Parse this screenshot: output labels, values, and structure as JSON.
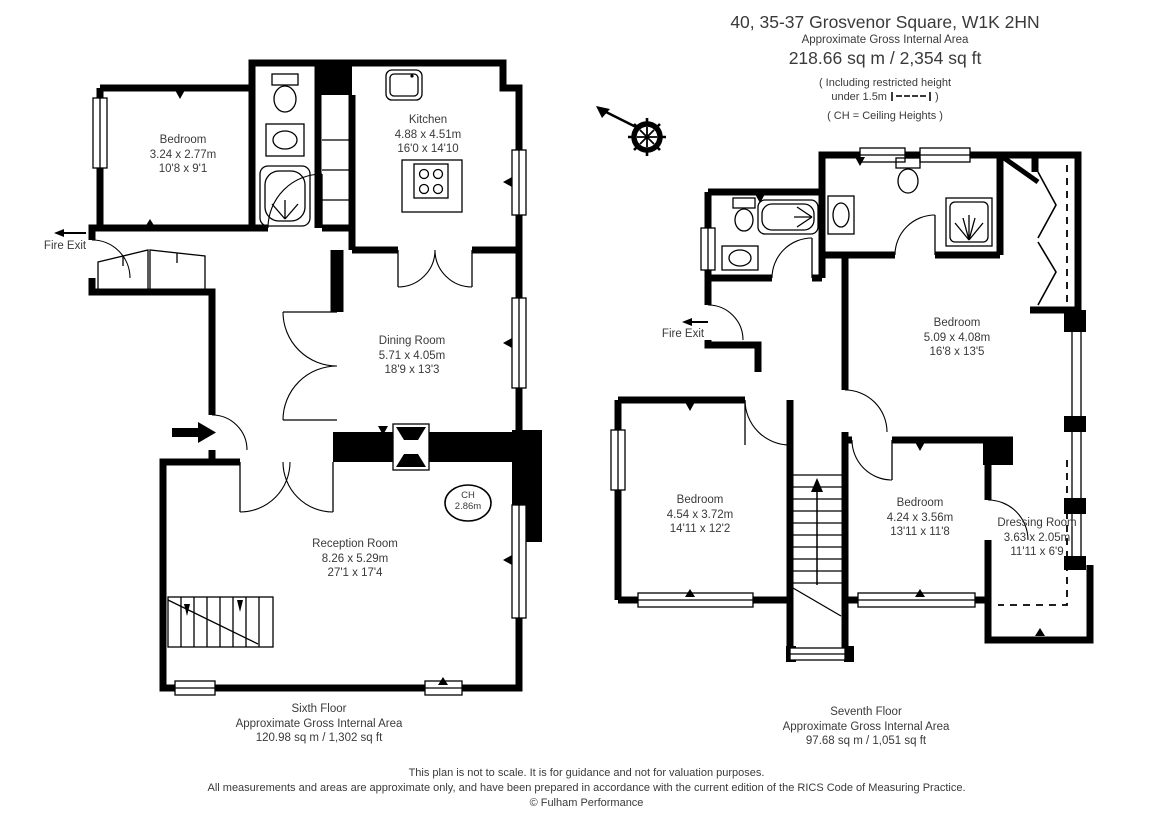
{
  "header": {
    "title": "40, 35-37 Grosvenor Square, W1K 2HN",
    "subtitle": "Approximate Gross Internal Area",
    "total_area": "218.66 sq m  /  2,354 sq ft",
    "note_restricted_1": "( Including restricted height",
    "note_restricted_2": "under 1.5m",
    "note_restricted_close": ")",
    "note_ch": "( CH = Ceiling Heights )"
  },
  "icons": {
    "compass": "ship-wheel-north-arrow",
    "fire_exit_arrow": "left-arrow",
    "entrance_arrow": "right-arrow"
  },
  "sixth_floor": {
    "fire_exit": "Fire Exit",
    "ceiling_height": {
      "line1": "CH",
      "line2": "2.86m"
    },
    "rooms": {
      "bedroom": {
        "name": "Bedroom",
        "metric": "3.24 x 2.77m",
        "imperial": "10'8 x 9'1"
      },
      "kitchen": {
        "name": "Kitchen",
        "metric": "4.88 x 4.51m",
        "imperial": "16'0 x 14'10"
      },
      "dining": {
        "name": "Dining Room",
        "metric": "5.71 x 4.05m",
        "imperial": "18'9 x 13'3"
      },
      "reception": {
        "name": "Reception Room",
        "metric": "8.26 x 5.29m",
        "imperial": "27'1 x 17'4"
      }
    },
    "caption": {
      "line1": "Sixth Floor",
      "line2": "Approximate Gross Internal Area",
      "line3": "120.98 sq m  /  1,302 sq ft"
    }
  },
  "seventh_floor": {
    "fire_exit": "Fire Exit",
    "rooms": {
      "bedroom_main": {
        "name": "Bedroom",
        "metric": "5.09 x 4.08m",
        "imperial": "16'8 x 13'5"
      },
      "bedroom_left": {
        "name": "Bedroom",
        "metric": "4.54 x 3.72m",
        "imperial": "14'11 x 12'2"
      },
      "bedroom_right": {
        "name": "Bedroom",
        "metric": "4.24 x 3.56m",
        "imperial": "13'11 x 11'8"
      },
      "dressing": {
        "name": "Dressing Room",
        "metric": "3.63 x 2.05m",
        "imperial": "11'11 x 6'9"
      }
    },
    "caption": {
      "line1": "Seventh Floor",
      "line2": "Approximate Gross Internal Area",
      "line3": "97.68 sq m  /  1,051 sq ft"
    }
  },
  "footer": {
    "line1": "This plan is not to scale. It is for guidance and not for valuation purposes.",
    "line2": "All measurements and areas are approximate only, and have been prepared in accordance with the current edition of the RICS Code of Measuring Practice.",
    "line3": "© Fulham Performance"
  },
  "colors": {
    "wall": "#000000",
    "text": "#3a3a3a",
    "background": "#ffffff"
  }
}
